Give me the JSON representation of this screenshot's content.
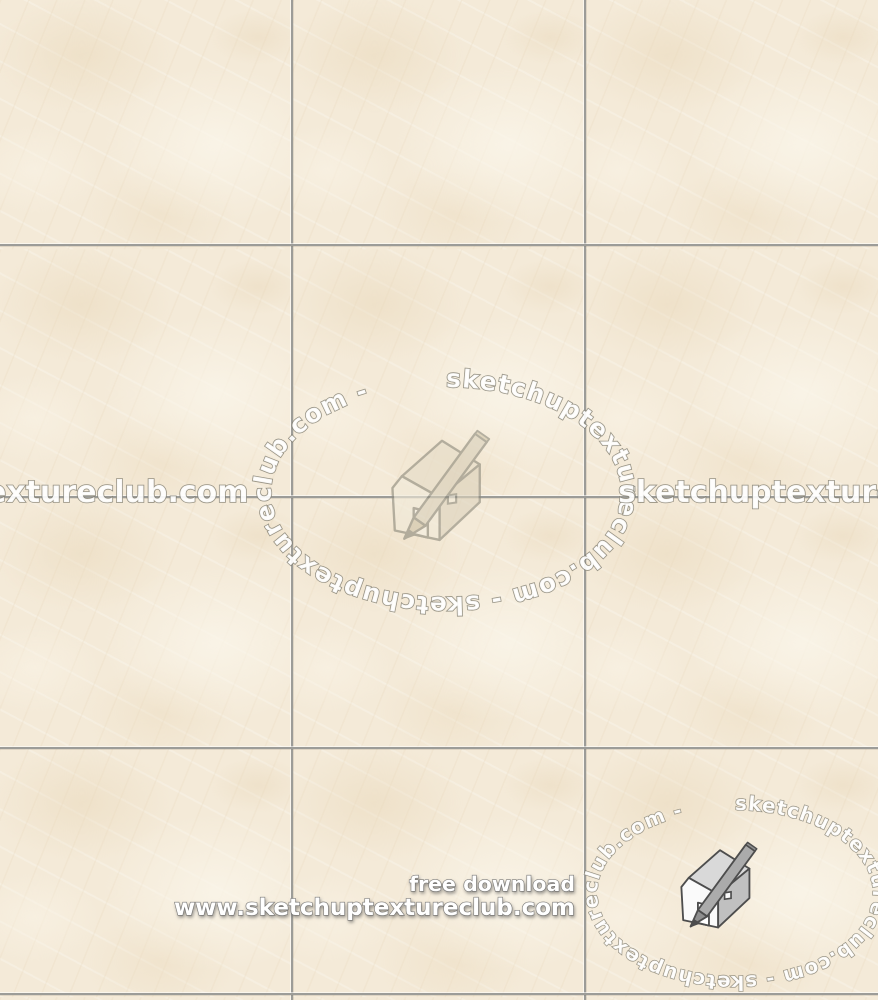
{
  "watermarks": {
    "ellipse_text": "sketchuptextureclub.com - sketchuptextureclub.com -",
    "horizontal_text": "sketchuptextureclub.com",
    "free_download_label": "free download",
    "site_url": "www.sketchuptextureclub.com",
    "logo_name": "sketchup-house-pencil-logo"
  },
  "texture": {
    "grid": {
      "columns": 3,
      "rows": 4
    },
    "colors": {
      "tile_base": "#f4ead8",
      "tile_vein": "#e8d8bc",
      "tile_highlight": "#faf4e8",
      "grout_line": "#9c9c98",
      "watermark_fill": "#ffffff",
      "watermark_outline": "#807d6e",
      "download_text_fill": "#ffffff"
    }
  }
}
